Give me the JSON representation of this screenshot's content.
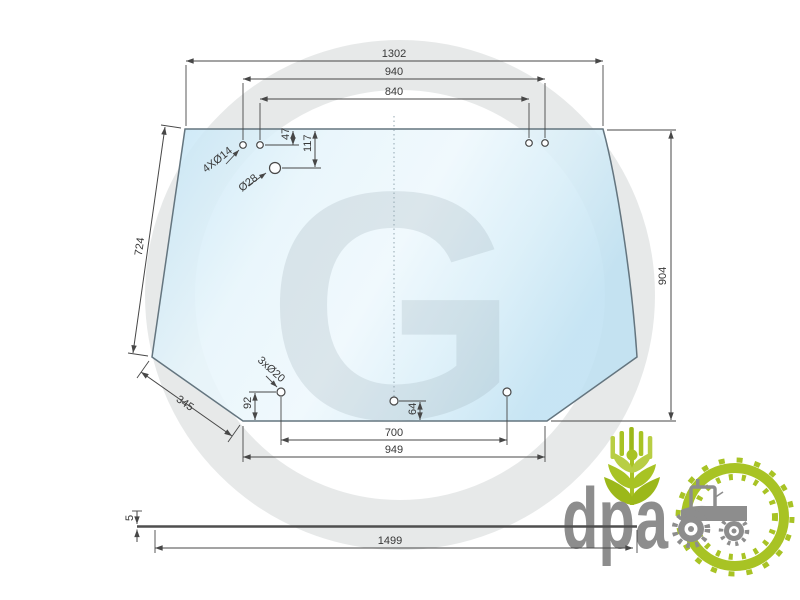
{
  "diagram": {
    "dimensions": {
      "top_width": "1302",
      "top_holes_outer": "940",
      "top_holes_inner": "840",
      "top_hole_offset": "47",
      "large_hole_offset": "117",
      "left_edge_length": "724",
      "right_height": "904",
      "bottom_left_edge": "345",
      "bottom_hole_offset_left": "92",
      "bottom_hole_offset_center": "64",
      "bottom_holes_span": "700",
      "bottom_width": "949",
      "glass_thickness": "5",
      "overall_length": "1499"
    },
    "callouts": {
      "top_holes": "4XØ14",
      "large_hole": "Ø28",
      "bottom_holes": "3xØ20"
    },
    "watermark_letter": "G"
  },
  "logo": {
    "text": "dpa"
  },
  "colors": {
    "line": "#474747",
    "glass_stroke": "#64757f",
    "logo_green": "#a8c324",
    "logo_green_light": "#b8ce44",
    "logo_green_dark": "#9cb81a",
    "logo_gray": "#8d8d8d"
  }
}
